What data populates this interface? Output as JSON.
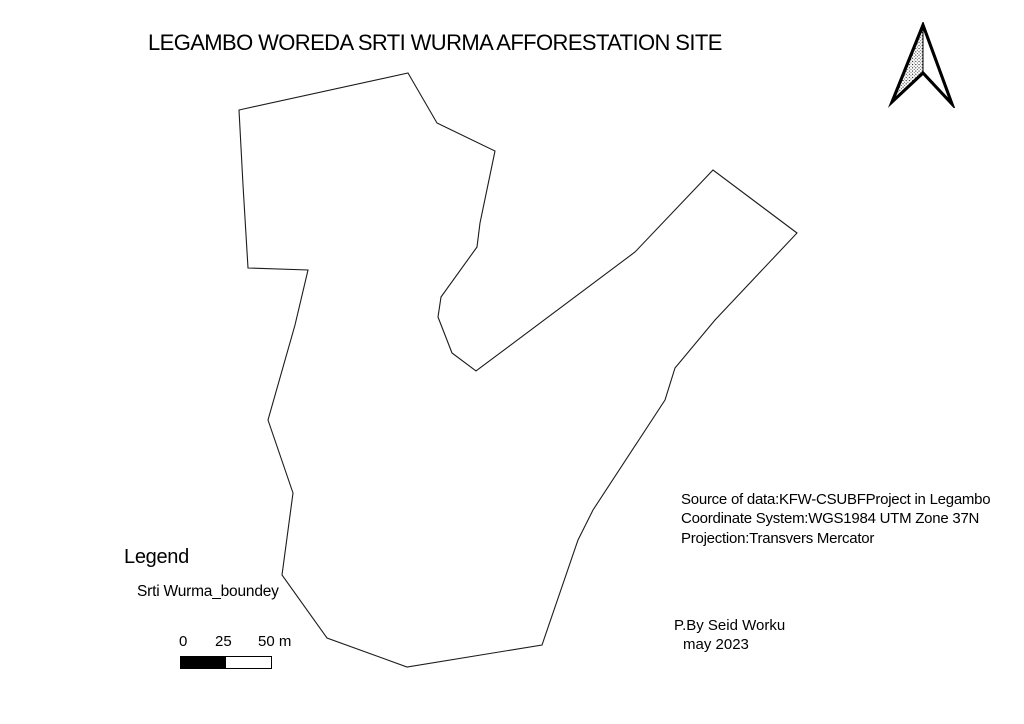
{
  "title": {
    "text": "LEGAMBO WOREDA SRTI WURMA AFFORESTATION SITE"
  },
  "north_arrow": {
    "icon": "north-arrow",
    "meaning": "north orientation"
  },
  "map": {
    "feature_name": "Srti Wurma afforestation site boundary",
    "stroke_color": "#1c1c1c",
    "boundary_points": "408,73 437,123 495,151 480,223 477,247 441,297 438,317 452,353 476,371 635,252 713,170 797,233 715,320 675,368 665,400 593,510 578,540 542,645 407,667 327,638 282,575 293,493 268,420 295,325 308,270 248,268 243,185 239,110"
  },
  "legend": {
    "heading": "Legend",
    "items": [
      {
        "label": "Srti Wurma_boundey"
      }
    ]
  },
  "scale_bar": {
    "tick_labels": [
      "0",
      "25",
      "50 m"
    ],
    "units": "m",
    "segment_colors": [
      "#000000",
      "#ffffff"
    ]
  },
  "source_info": {
    "lines": [
      "Source of data:KFW-CSUBFProject in Legambo",
      "Coordinate System:WGS1984 UTM Zone 37N",
      "Projection:Transvers Mercator"
    ]
  },
  "credit": {
    "lines": [
      "P.By Seid Worku",
      "may 2023"
    ]
  }
}
